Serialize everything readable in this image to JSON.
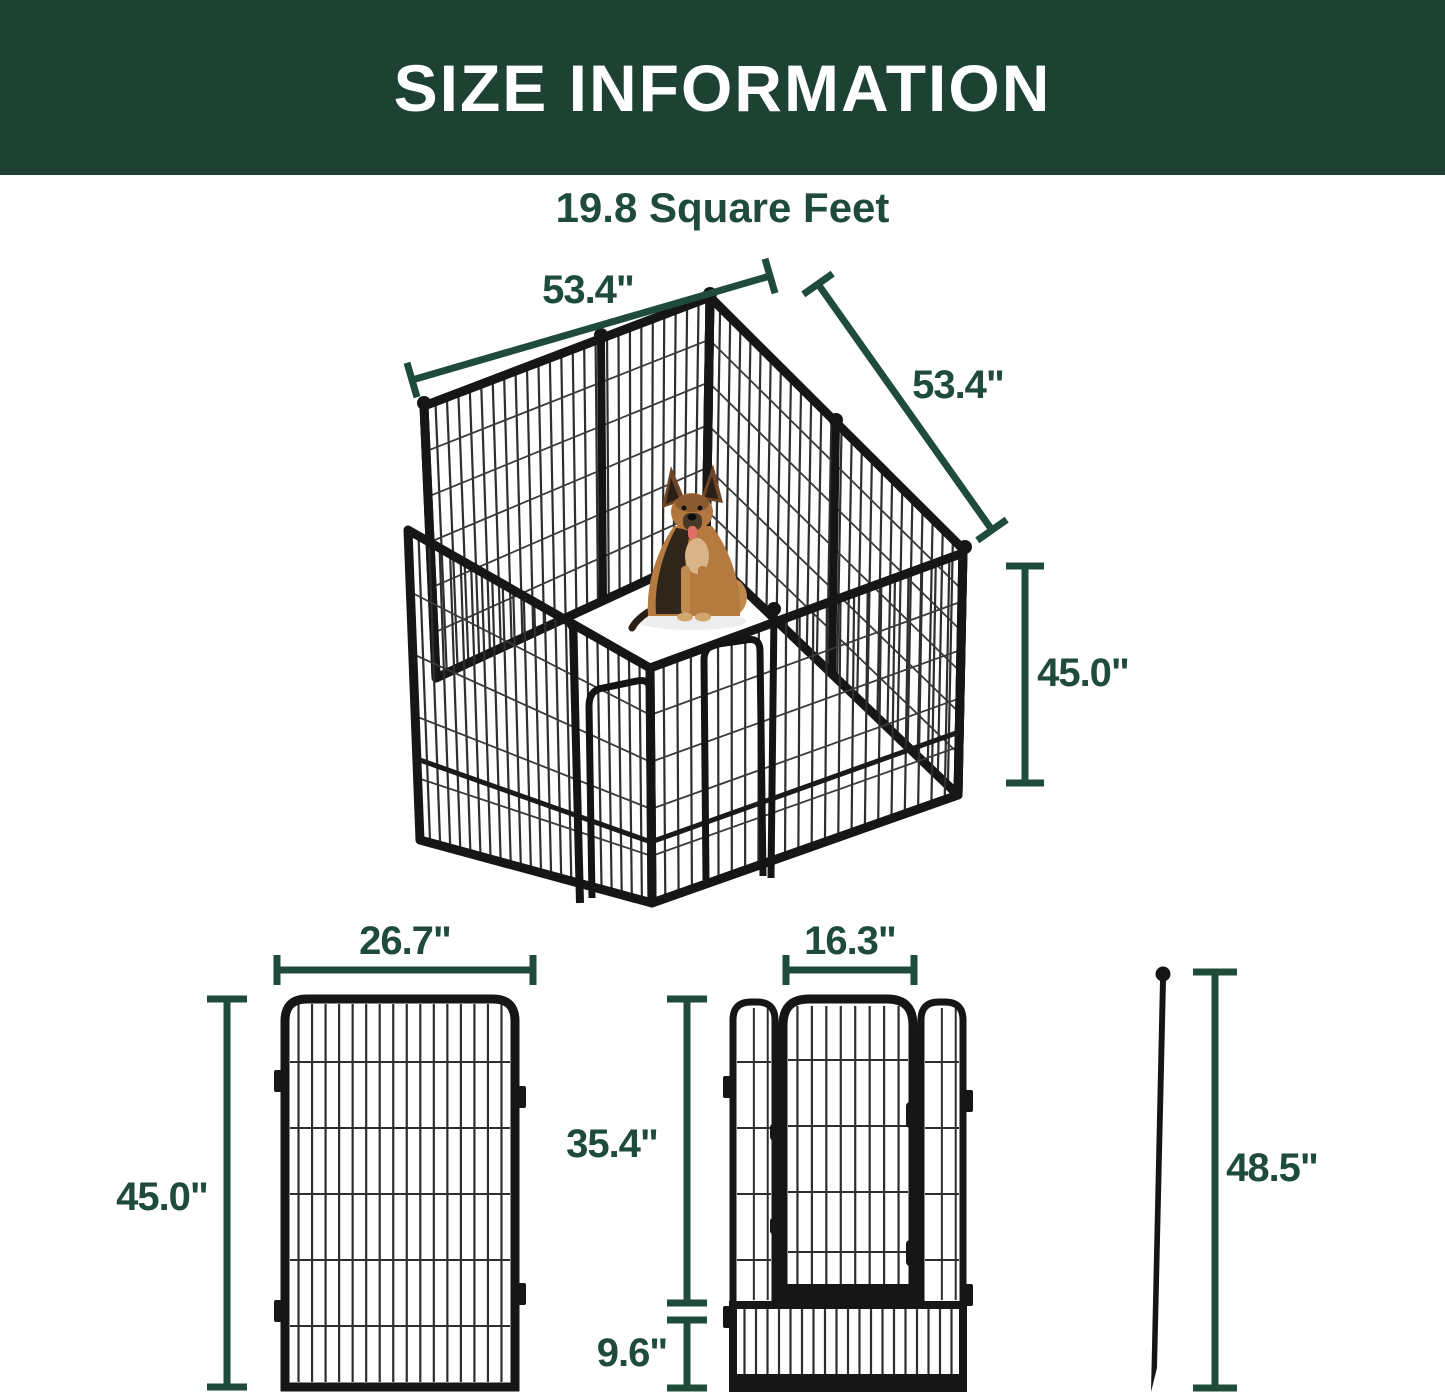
{
  "banner": {
    "title": "SIZE INFORMATION"
  },
  "headline": {
    "text": "19.8 Square Feet"
  },
  "colors": {
    "banner_bg": "#1D4233",
    "banner_text": "#FFFFFF",
    "dimension_green": "#1F4B3A",
    "metal_dark": "#161616"
  },
  "main_diagram": {
    "description": "assembled 8-panel metal dog playpen with German Shepherd inside",
    "width_top": "53.4\"",
    "depth_right": "53.4\"",
    "height_right": "45.0\""
  },
  "panel_diagram": {
    "width": "26.7\"",
    "height": "45.0\""
  },
  "door_diagram": {
    "door_width": "16.3\"",
    "door_height": "35.4\"",
    "bottom_height": "9.6\""
  },
  "stake_diagram": {
    "height": "48.5\""
  }
}
